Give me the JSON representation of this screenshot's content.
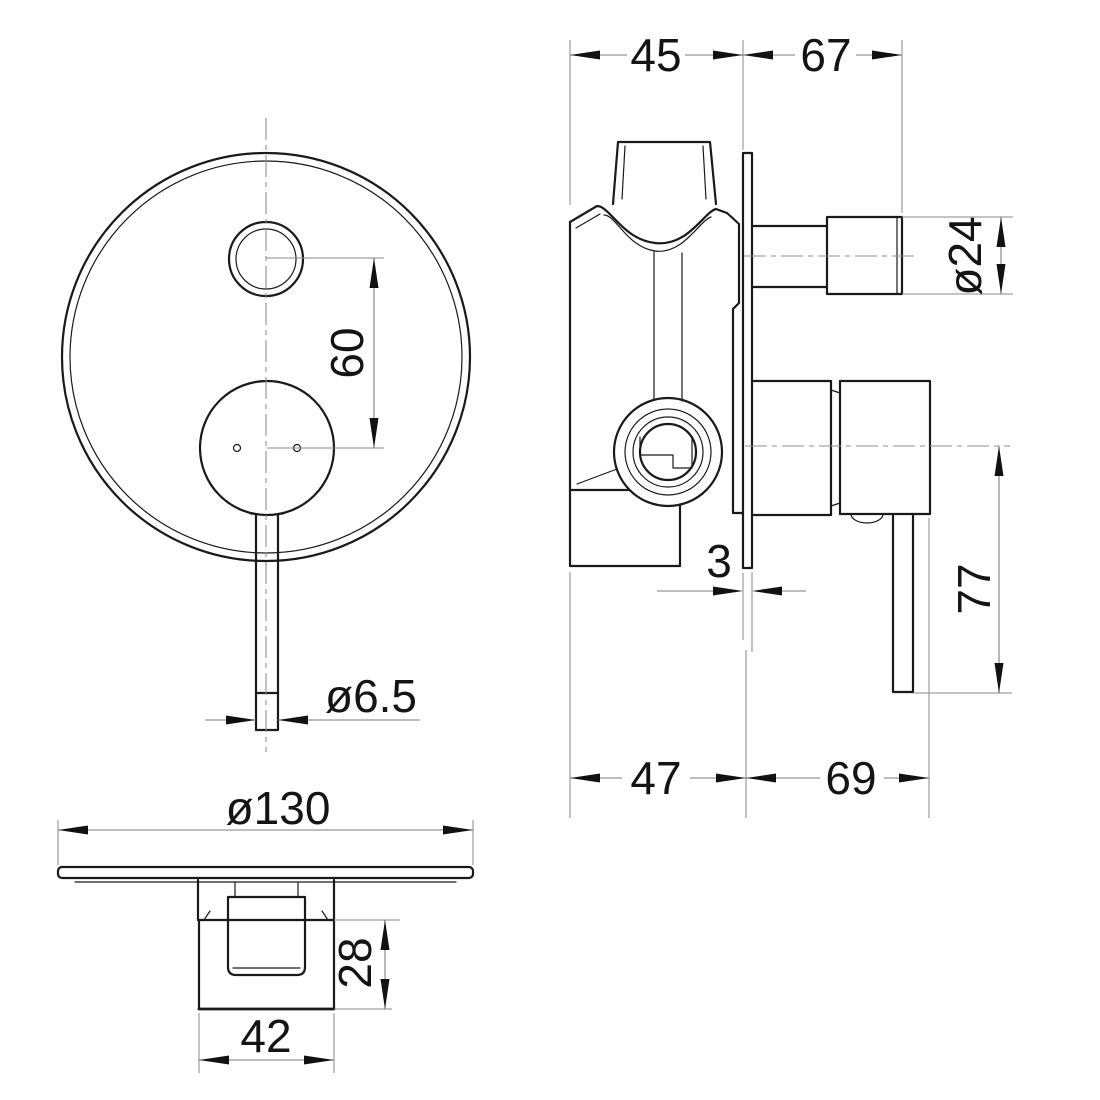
{
  "page": {
    "background": "#ffffff",
    "description": "Technical dimension drawing of a concealed wall-mounted shower mixer valve with diverter, shown in three orthographic views"
  },
  "colors": {
    "outline": "#1a1a1a",
    "dimension_line": "#7d7d7d",
    "centerline": "#8f8f8f",
    "text": "#141414"
  },
  "views": {
    "front": "front view of round cover plate with diverter knob and lever",
    "side": "side section view of valve body through wall plate",
    "bottom": "bottom view of cover plate and handle body"
  },
  "dimensions": {
    "body_depth_behind_wall": "45",
    "projection_from_wall": "67",
    "outlet_diameter": "ø24",
    "outlet_to_cartridge_spacing": "60",
    "plate_thickness": "3",
    "handle_drop": "77",
    "rough_in_depth": "47",
    "trim_projection": "69",
    "lever_diameter": "ø6.5",
    "plate_diameter": "ø130",
    "handle_body_height": "28",
    "handle_body_width": "42"
  }
}
